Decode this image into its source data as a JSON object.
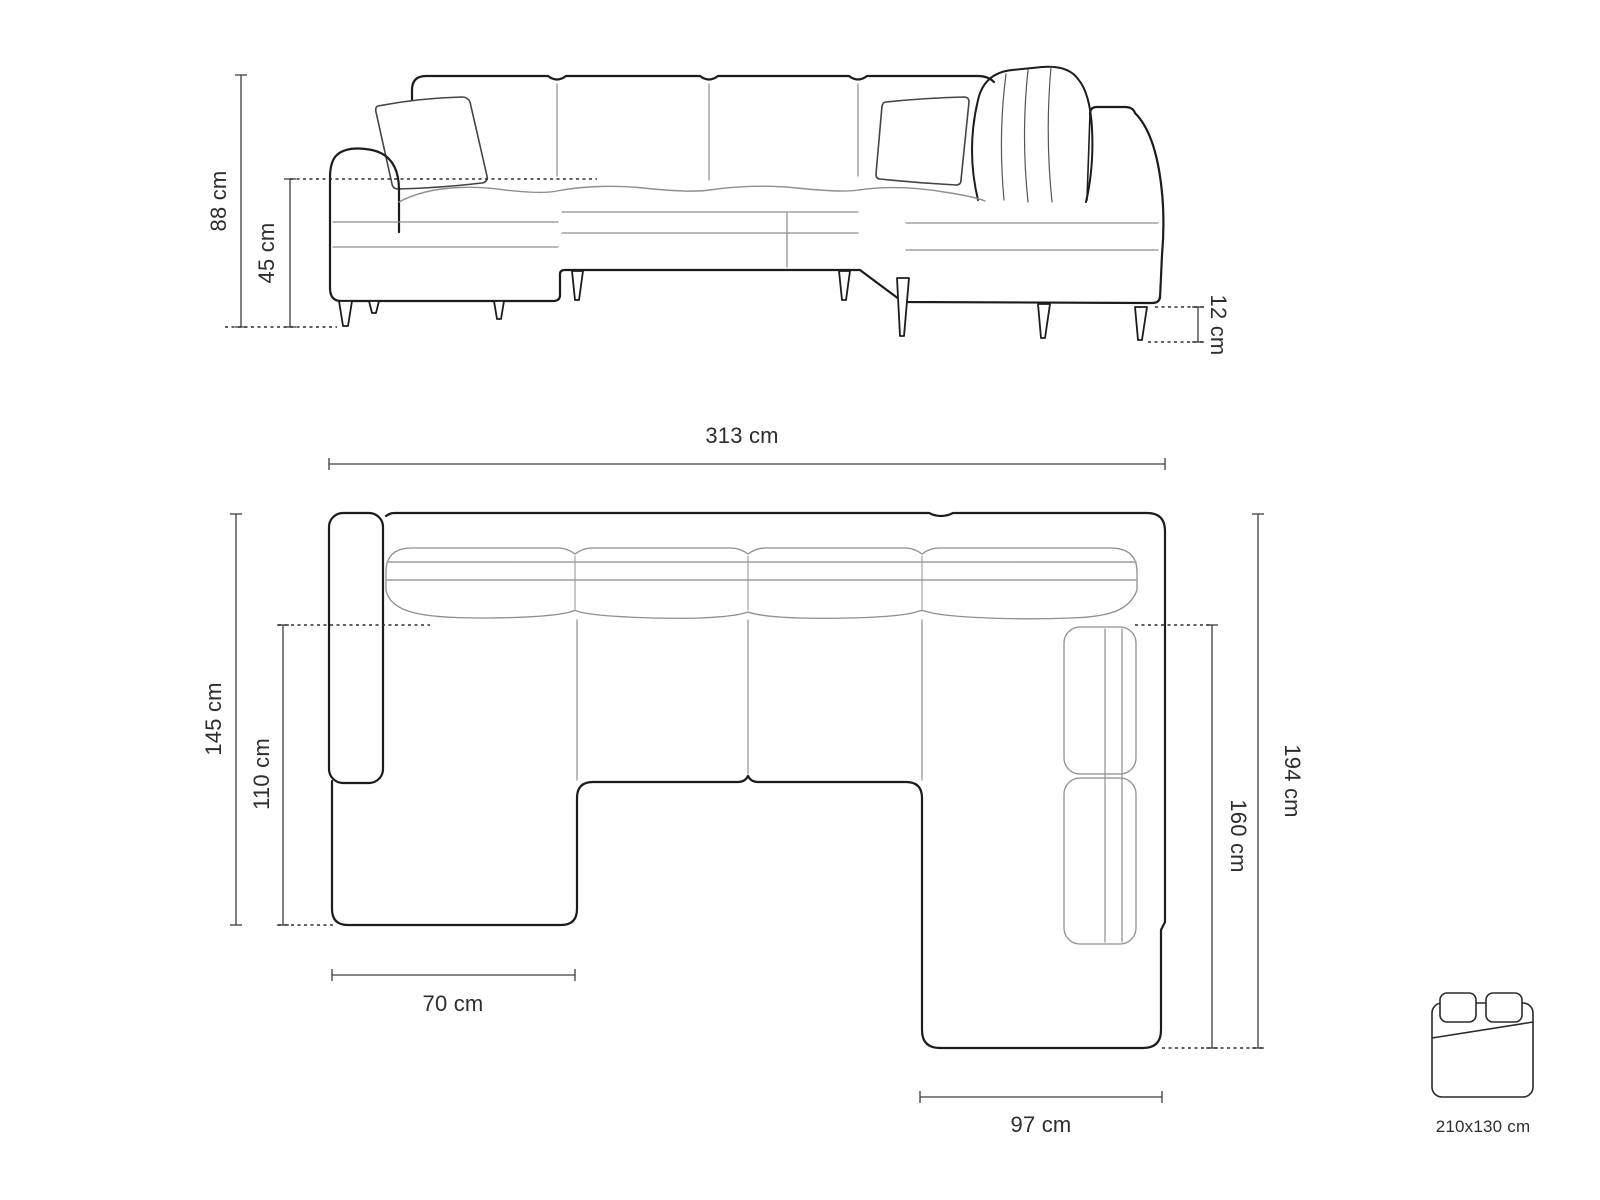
{
  "front_view": {
    "total_height": "88 cm",
    "seat_height": "45 cm",
    "leg_height": "12 cm"
  },
  "top_view": {
    "total_width": "313 cm",
    "left_depth": "145 cm",
    "left_chaise_length": "110 cm",
    "right_depth": "194 cm",
    "right_chaise_length": "160 cm",
    "left_chaise_width": "70 cm",
    "right_chaise_width": "97 cm"
  },
  "sleeping_area": {
    "size_label": "210x130 cm"
  },
  "colors": {
    "outline": "#1c1c1c",
    "seam": "#8f8f8f",
    "dimension": "#3d3d3d",
    "text": "#2d2d2d",
    "background": "#ffffff"
  }
}
